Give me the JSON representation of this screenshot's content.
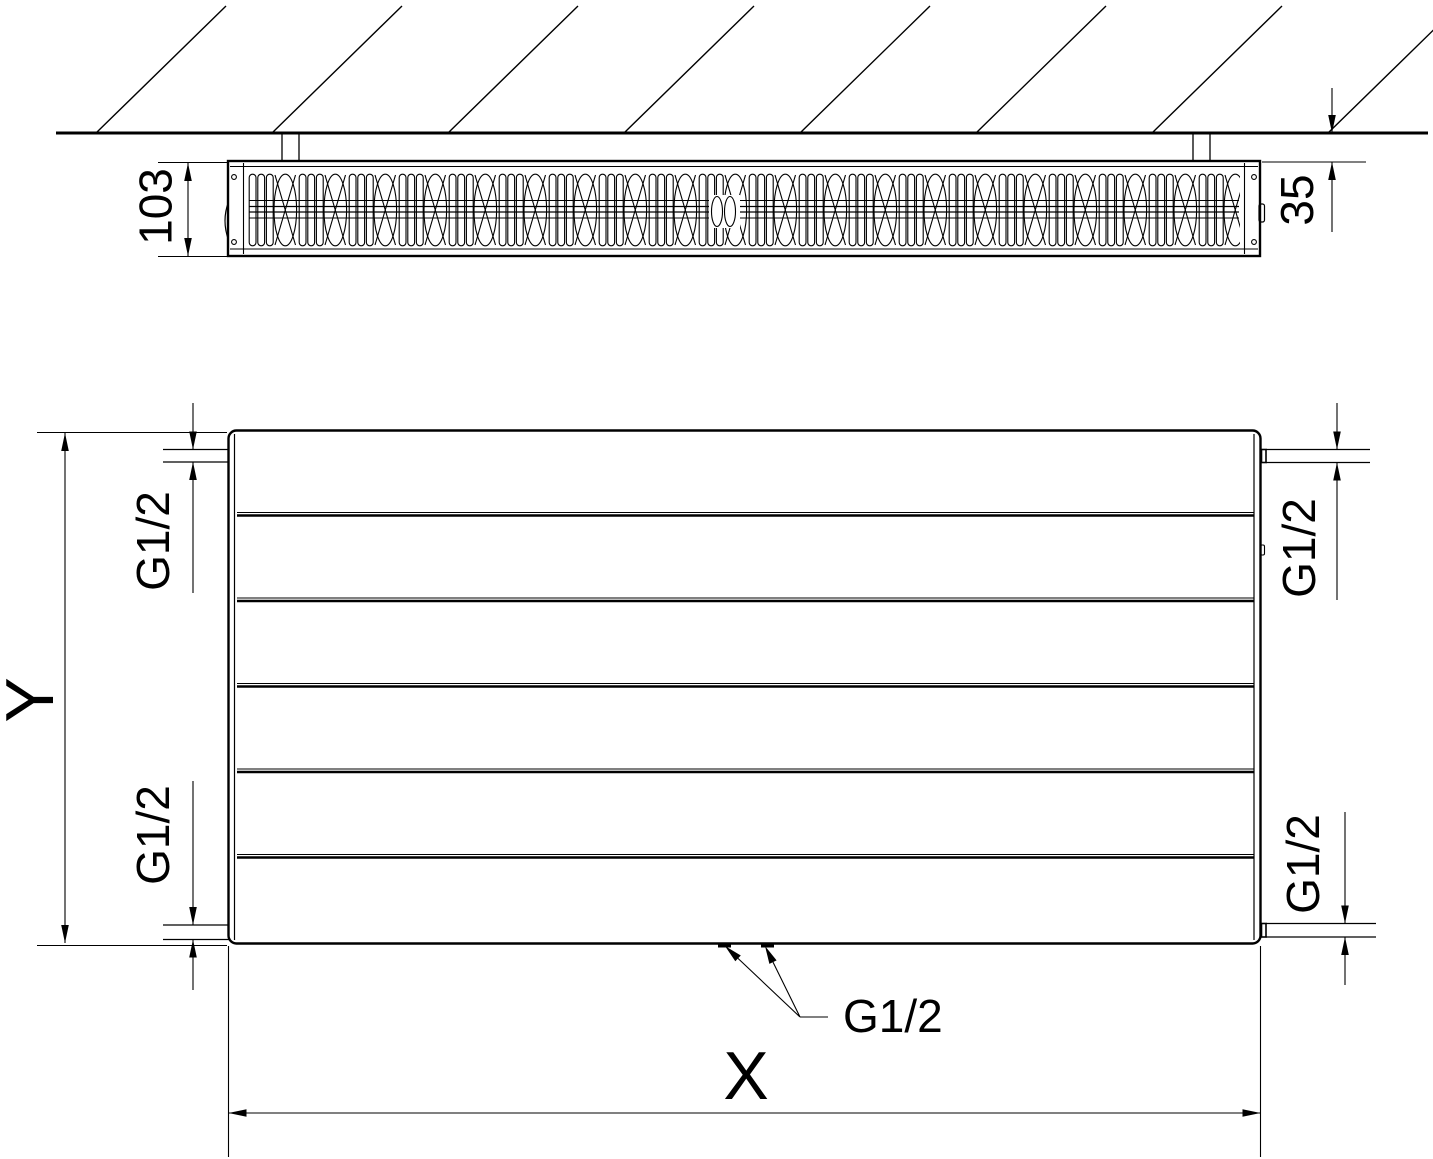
{
  "colors": {
    "background": "#ffffff",
    "line": "#000000"
  },
  "top_view": {
    "depth_label": "103",
    "wall_distance_label": "35"
  },
  "front_view": {
    "height_label": "Y",
    "width_label": "X",
    "conn_top_left": "G1/2",
    "conn_top_right": "G1/2",
    "conn_bottom_left": "G1/2",
    "conn_bottom_right": "G1/2",
    "conn_bottom_center": "G1/2"
  }
}
